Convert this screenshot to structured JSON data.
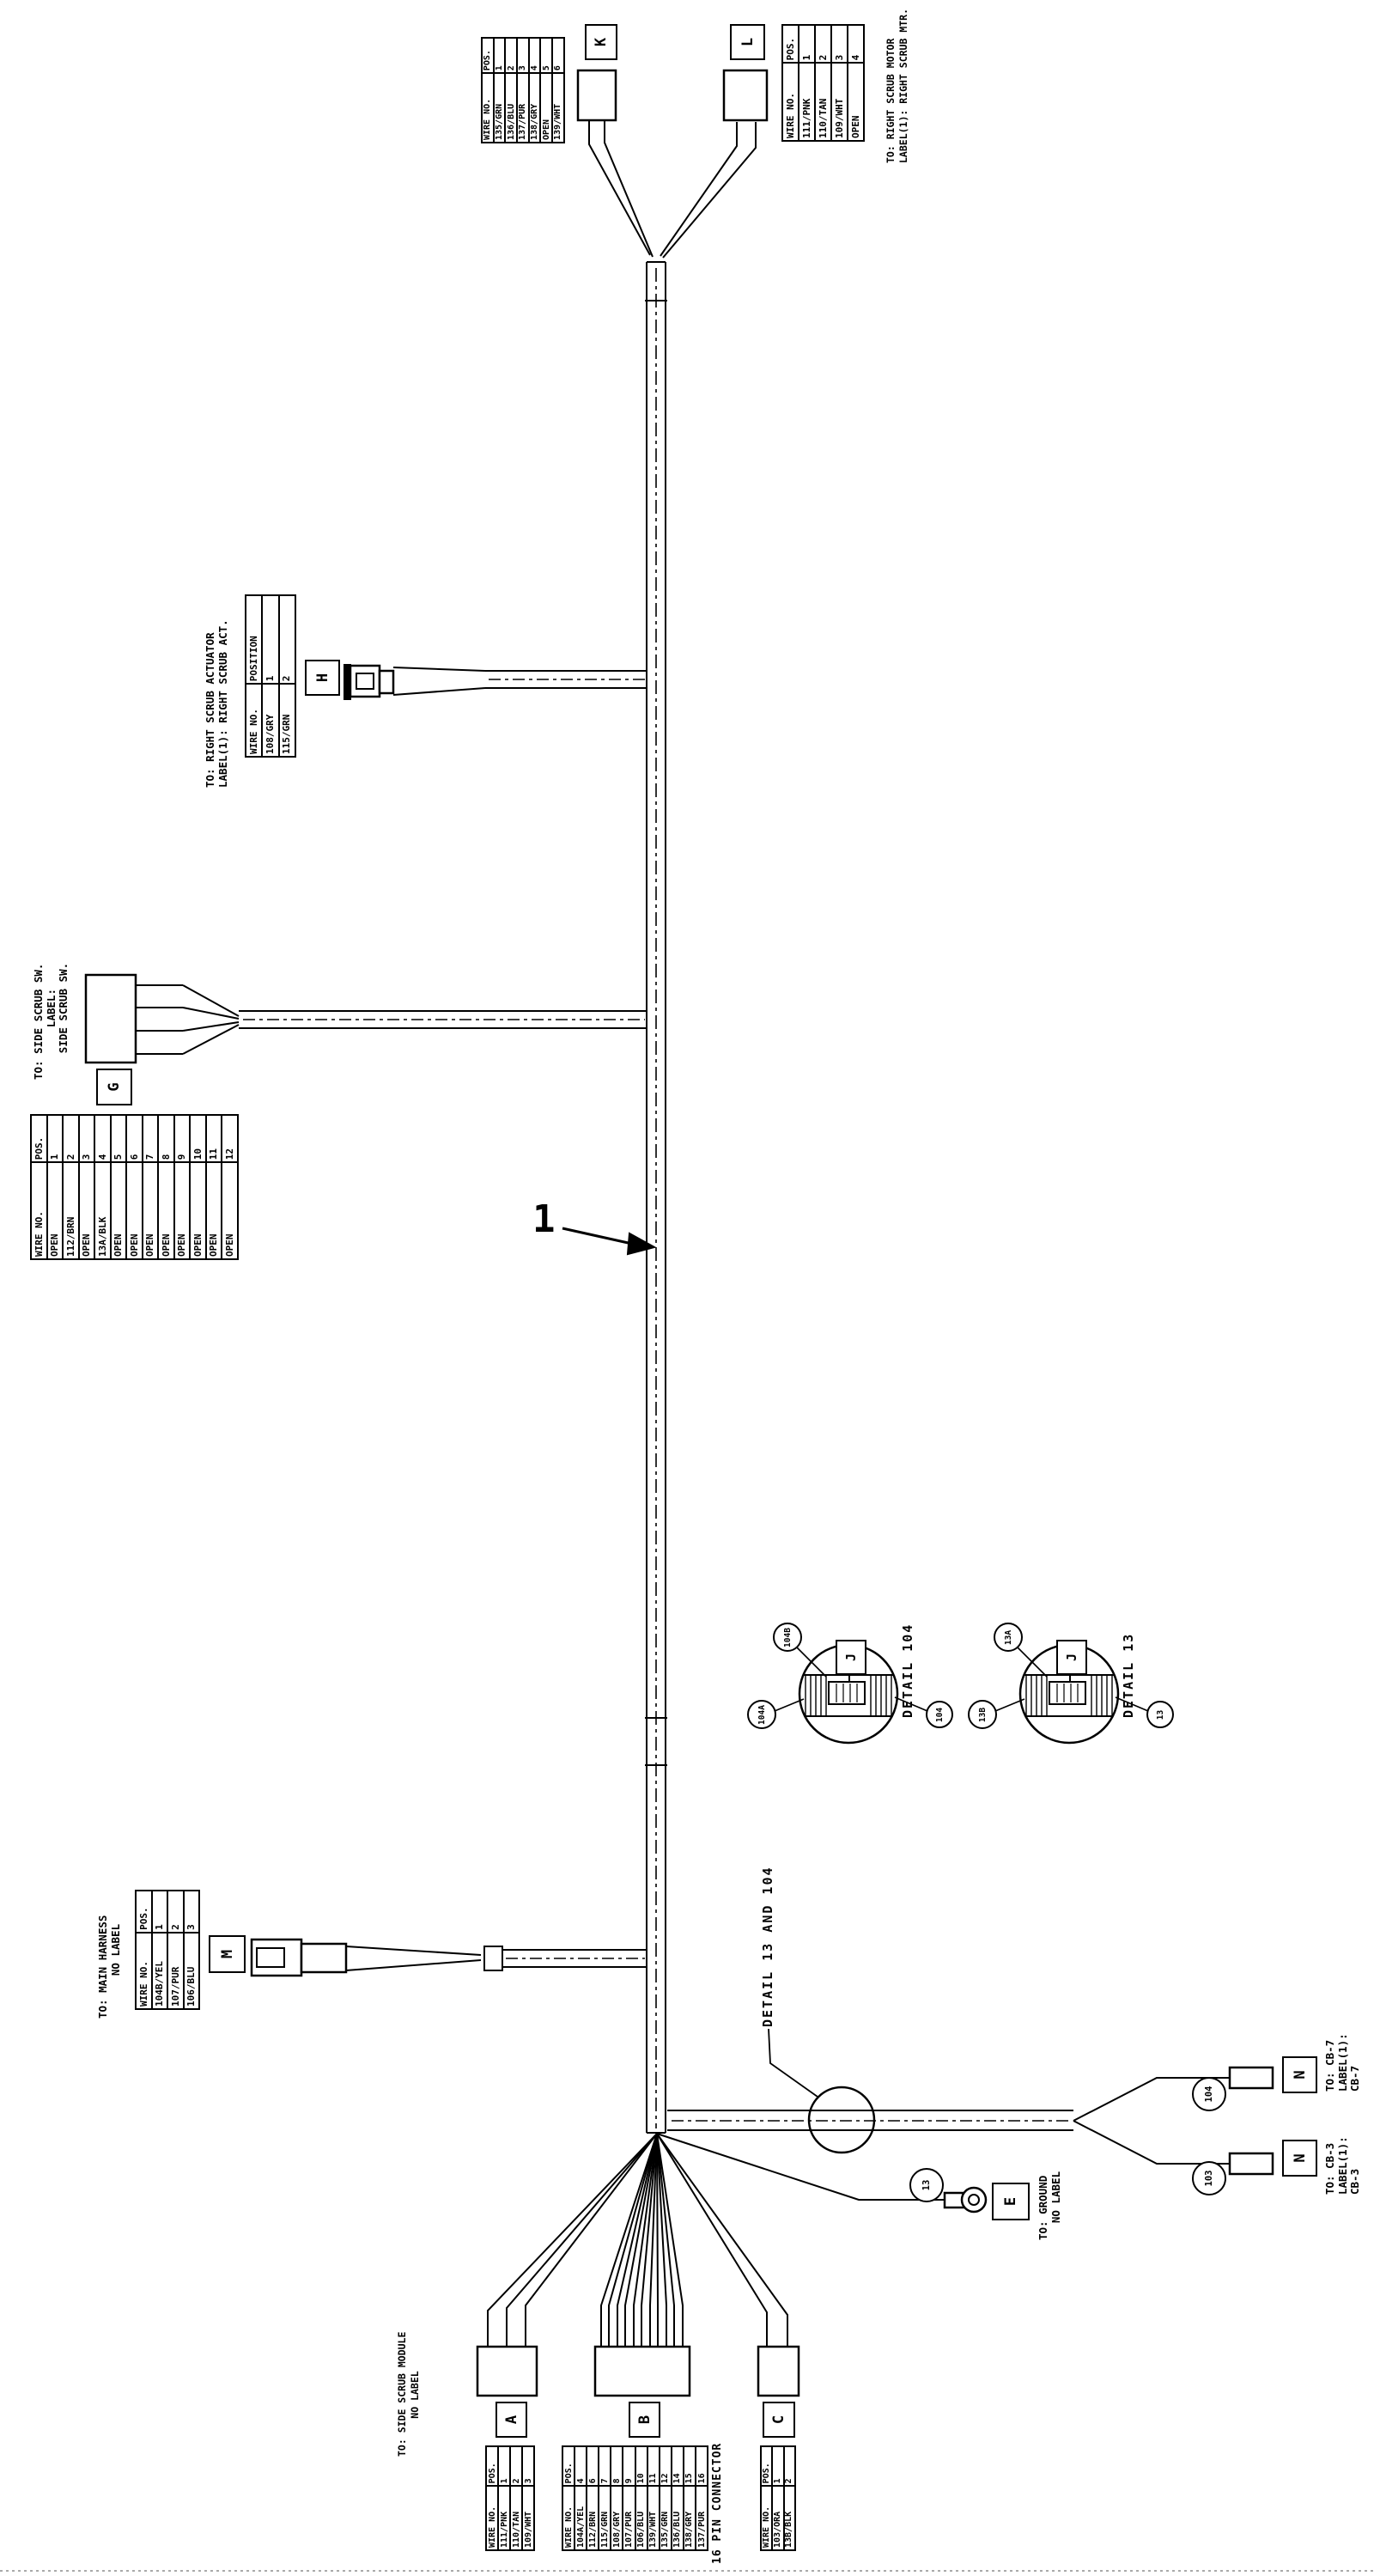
{
  "item_callout": "1",
  "letters": {
    "K": "K",
    "L": "L",
    "H": "H",
    "G": "G",
    "M": "M",
    "A": "A",
    "B": "B",
    "C": "C",
    "E": "E",
    "N": "N",
    "J": "J"
  },
  "texts": {
    "right_scrub_motor": [
      "TO: RIGHT SCRUB MOTOR",
      "LABEL(1): RIGHT SCRUB MTR."
    ],
    "right_scrub_actuator": [
      "TO: RIGHT SCRUB ACTUATOR",
      "LABEL(1): RIGHT SCRUB ACT."
    ],
    "side_scrub_sw": [
      "TO: SIDE SCRUB SW.",
      "LABEL:",
      "SIDE SCRUB SW."
    ],
    "main_harness": [
      "TO: MAIN HARNESS",
      "NO LABEL"
    ],
    "side_scrub_module": [
      "TO: SIDE SCRUB MODULE",
      "NO LABEL"
    ],
    "ground": [
      "TO: GROUND",
      "NO LABEL"
    ],
    "cb7": [
      "TO: CB-7",
      "LABEL(1):",
      "CB-7"
    ],
    "cb3": [
      "TO: CB-3",
      "LABEL(1):",
      "CB-3"
    ],
    "detail104": "DETAIL 104",
    "detail13": "DETAIL 13",
    "detail_both": "DETAIL 13 AND 104",
    "pin16": "16 PIN CONNECTOR"
  },
  "balloons": {
    "b104B": "104B",
    "b104A": "104A",
    "b104": "104",
    "b13A": "13A",
    "b13B": "13B",
    "b13": "13",
    "w104": "104",
    "w103": "103",
    "w13": "13"
  },
  "tables": {
    "K": {
      "head": [
        "WIRE NO.",
        "POS."
      ],
      "rows": [
        [
          "135/GRN",
          "1"
        ],
        [
          "136/BLU",
          "2"
        ],
        [
          "137/PUR",
          "3"
        ],
        [
          "138/GRY",
          "4"
        ],
        [
          "OPEN",
          "5"
        ],
        [
          "139/WHT",
          "6"
        ]
      ]
    },
    "L": {
      "head": [
        "WIRE NO.",
        "POS."
      ],
      "rows": [
        [
          "111/PNK",
          "1"
        ],
        [
          "110/TAN",
          "2"
        ],
        [
          "109/WHT",
          "3"
        ],
        [
          "OPEN",
          "4"
        ]
      ]
    },
    "H": {
      "head": [
        "WIRE NO.",
        "POSITION"
      ],
      "rows": [
        [
          "108/GRY",
          "1"
        ],
        [
          "115/GRN",
          "2"
        ]
      ]
    },
    "G": {
      "head": [
        "WIRE NO.",
        "POS."
      ],
      "rows": [
        [
          "OPEN",
          "1"
        ],
        [
          "112/BRN",
          "2"
        ],
        [
          "OPEN",
          "3"
        ],
        [
          "13A/BLK",
          "4"
        ],
        [
          "OPEN",
          "5"
        ],
        [
          "OPEN",
          "6"
        ],
        [
          "OPEN",
          "7"
        ],
        [
          "OPEN",
          "8"
        ],
        [
          "OPEN",
          "9"
        ],
        [
          "OPEN",
          "10"
        ],
        [
          "OPEN",
          "11"
        ],
        [
          "OPEN",
          "12"
        ]
      ]
    },
    "M": {
      "head": [
        "WIRE NO.",
        "POS."
      ],
      "rows": [
        [
          "104B/YEL",
          "1"
        ],
        [
          "107/PUR",
          "2"
        ],
        [
          "106/BLU",
          "3"
        ]
      ]
    },
    "A": {
      "head": [
        "WIRE NO.",
        "POS."
      ],
      "rows": [
        [
          "111/PNK",
          "1"
        ],
        [
          "110/TAN",
          "2"
        ],
        [
          "109/WHT",
          "3"
        ]
      ]
    },
    "B": {
      "head": [
        "WIRE NO.",
        "POS."
      ],
      "rows": [
        [
          "104A/YEL",
          "4"
        ],
        [
          "112/BRN",
          "6"
        ],
        [
          "115/GRN",
          "7"
        ],
        [
          "108/GRY",
          "8"
        ],
        [
          "107/PUR",
          "9"
        ],
        [
          "106/BLU",
          "10"
        ],
        [
          "139/WHT",
          "11"
        ],
        [
          "135/GRN",
          "12"
        ],
        [
          "136/BLU",
          "14"
        ],
        [
          "138/GRY",
          "15"
        ],
        [
          "137/PUR",
          "16"
        ]
      ]
    },
    "C": {
      "head": [
        "WIRE NO.",
        "POS."
      ],
      "rows": [
        [
          "103/ORA",
          "1"
        ],
        [
          "13B/BLK",
          "2"
        ]
      ]
    }
  }
}
